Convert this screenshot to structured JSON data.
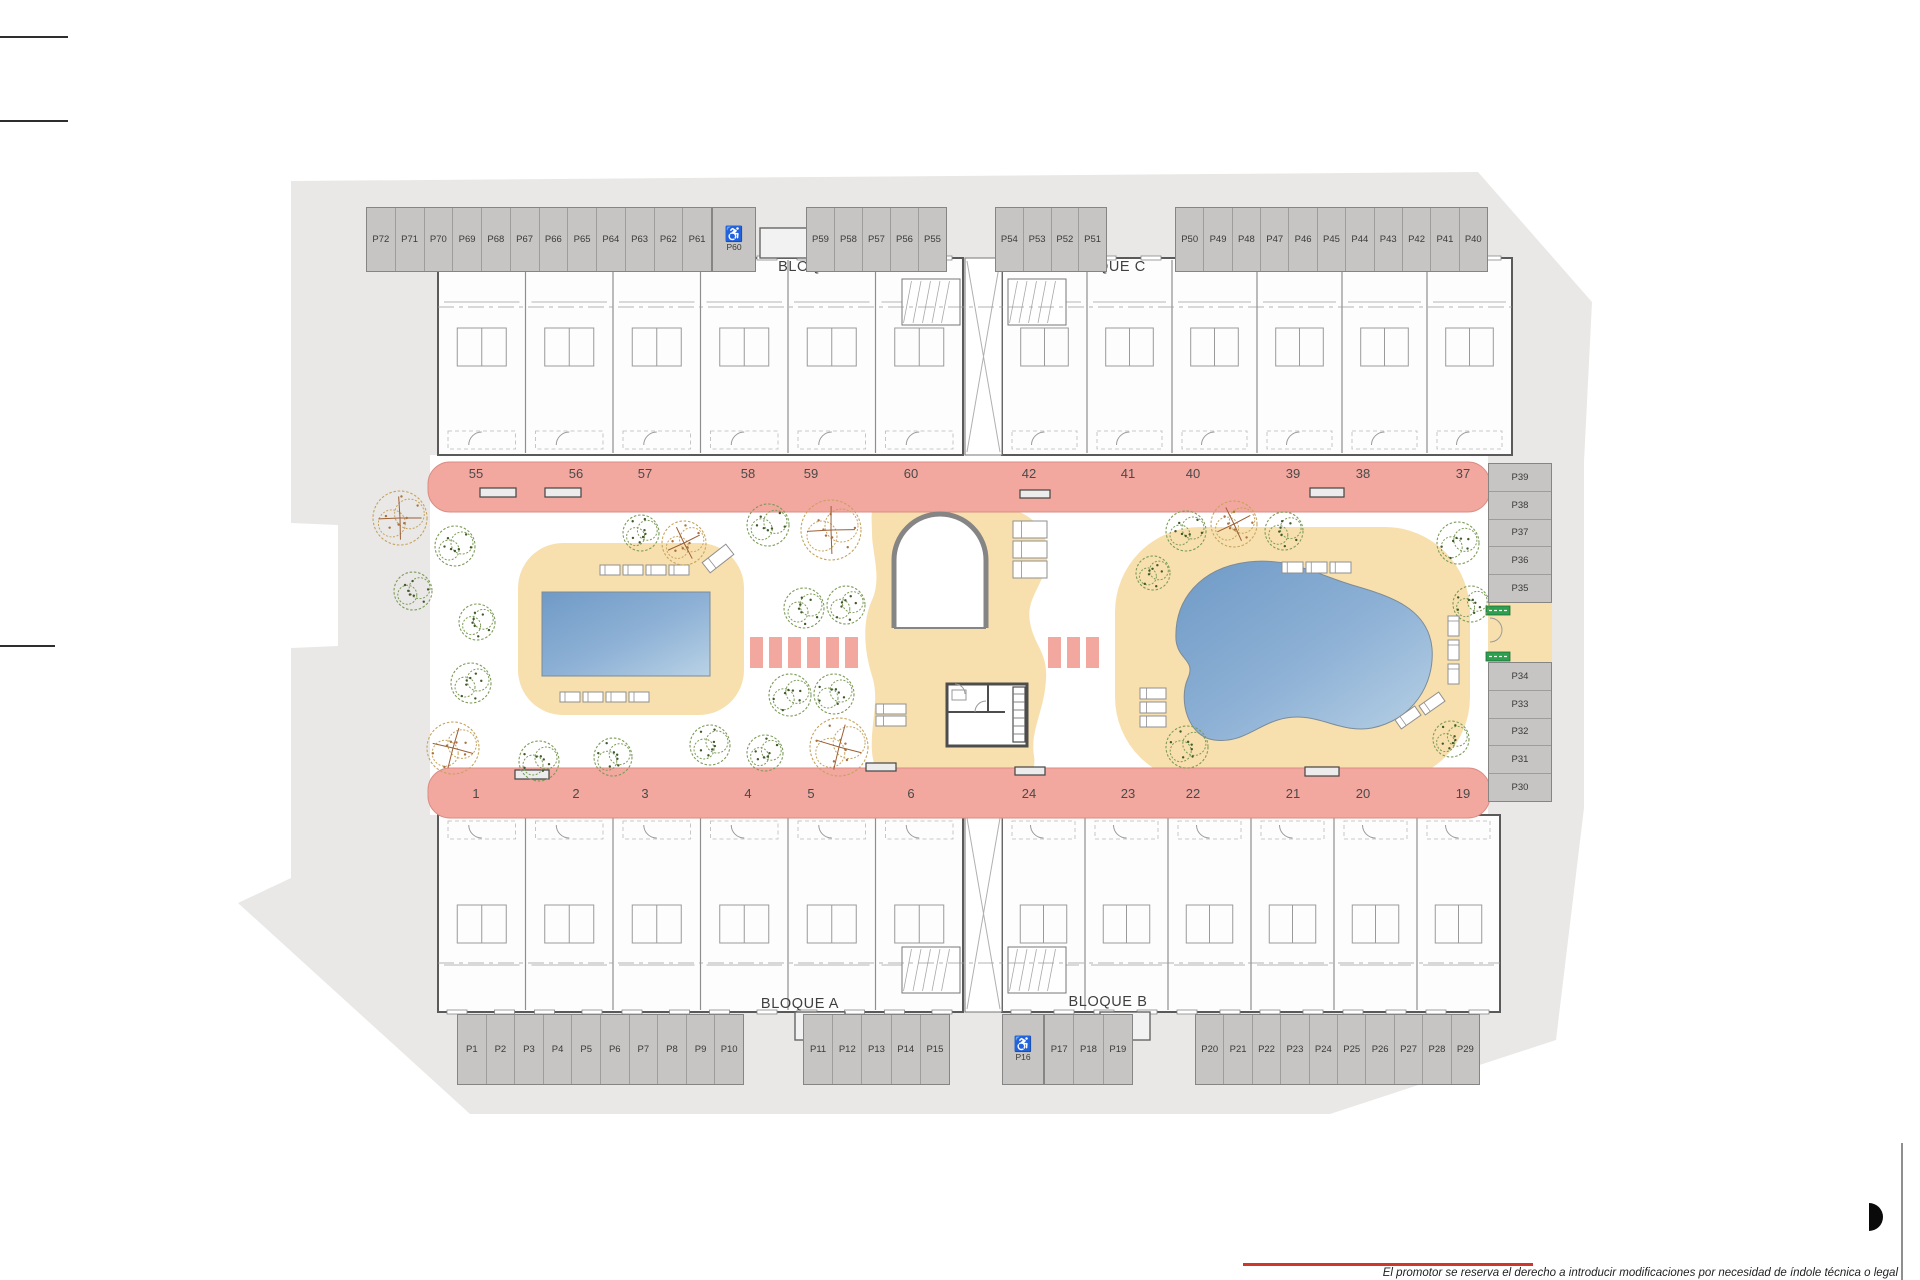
{
  "plan": {
    "blocks": {
      "d": "BLOQUE D",
      "c": "BLOQUE C",
      "a": "BLOQUE A",
      "b": "BLOQUE B"
    },
    "parking": {
      "top_left": [
        "P72",
        "P71",
        "P70",
        "P69",
        "P68",
        "P67",
        "P66",
        "P65",
        "P64",
        "P63",
        "P62",
        "P61"
      ],
      "top_left_accessible": "P60",
      "top_mid": [
        "P59",
        "P58",
        "P57",
        "P56",
        "P55"
      ],
      "top_mid2": [
        "P54",
        "P53",
        "P52",
        "P51"
      ],
      "top_right": [
        "P50",
        "P49",
        "P48",
        "P47",
        "P46",
        "P45",
        "P44",
        "P43",
        "P42",
        "P41",
        "P40"
      ],
      "right_upper": [
        "P39",
        "P38",
        "P37",
        "P36",
        "P35"
      ],
      "right_lower": [
        "P34",
        "P33",
        "P32",
        "P31",
        "P30"
      ],
      "bottom_left": [
        "P1",
        "P2",
        "P3",
        "P4",
        "P5",
        "P6",
        "P7",
        "P8",
        "P9",
        "P10"
      ],
      "bottom_mid": [
        "P11",
        "P12",
        "P13",
        "P14",
        "P15"
      ],
      "bottom_accessible": "P16",
      "bottom_mid2": [
        "P17",
        "P18",
        "P19"
      ],
      "bottom_right": [
        "P20",
        "P21",
        "P22",
        "P23",
        "P24",
        "P25",
        "P26",
        "P27",
        "P28",
        "P29"
      ]
    },
    "units": {
      "top_d": [
        "55",
        "56",
        "57",
        "58",
        "59",
        "60"
      ],
      "top_c": [
        "42",
        "41",
        "40",
        "39",
        "38",
        "37"
      ],
      "bottom_a": [
        "1",
        "2",
        "3",
        "4",
        "5",
        "6"
      ],
      "bottom_b": [
        "24",
        "23",
        "22",
        "21",
        "20",
        "19"
      ]
    },
    "icons": {
      "accessible": "♿"
    },
    "disclaimer": "El promotor se reserva el derecho a introducir modificaciones por necesidad de índole técnica o legal",
    "colors": {
      "site": "#e9e8e6",
      "stall": "#c6c5c3",
      "walkway": "#f2a79f",
      "deck": "#f8e0ae",
      "pool_dark": "#6f9ac6",
      "pool_light": "#b9d2e6",
      "exit_badge": "#2e9e4f"
    }
  }
}
